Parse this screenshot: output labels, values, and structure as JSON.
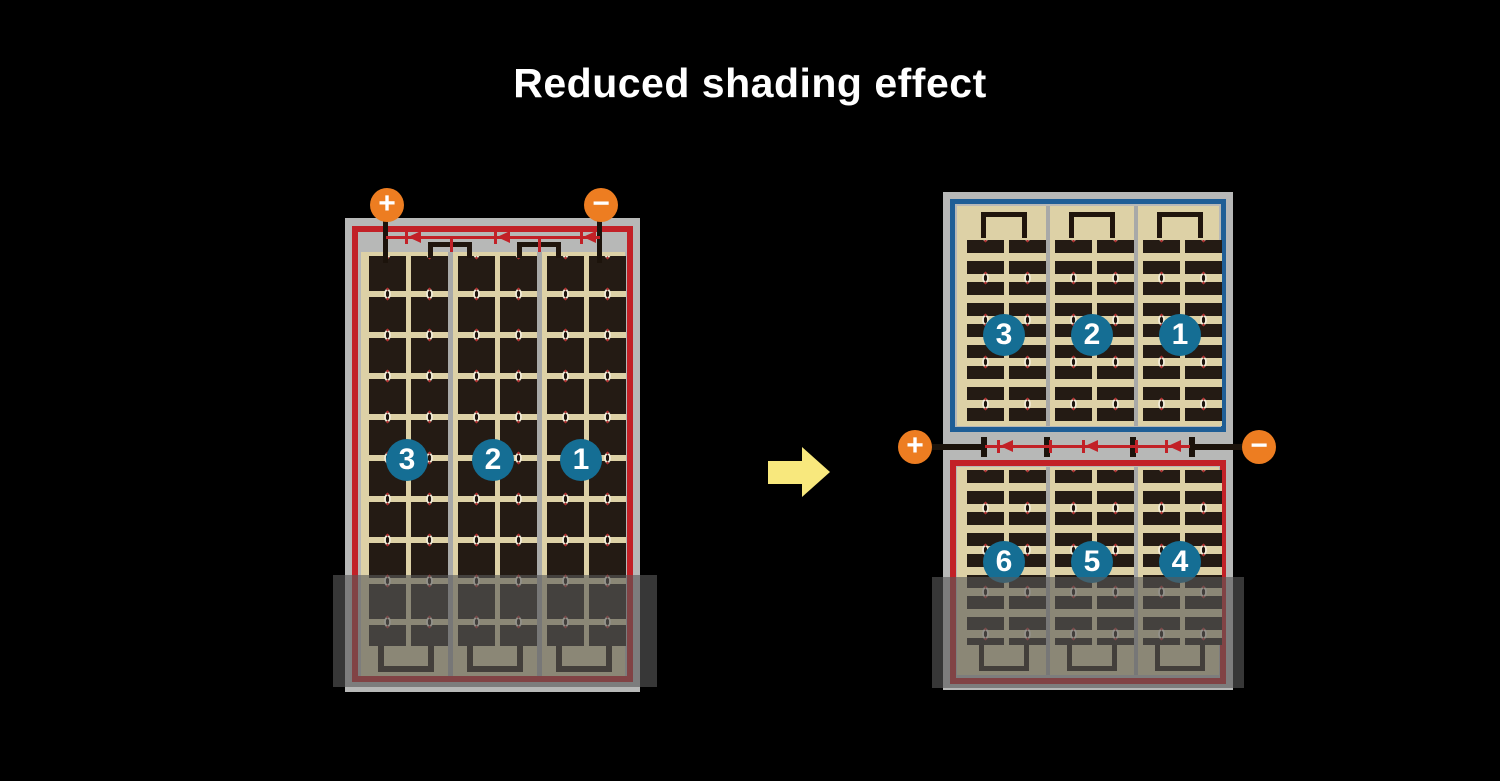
{
  "title": "Reduced shading effect",
  "left_module": {
    "terminals": {
      "plus": "+",
      "minus": "−"
    },
    "strings": [
      {
        "label": "3"
      },
      {
        "label": "2"
      },
      {
        "label": "1"
      }
    ]
  },
  "right_module": {
    "terminals": {
      "plus": "+",
      "minus": "−"
    },
    "top_half": {
      "strings": [
        {
          "label": "3"
        },
        {
          "label": "2"
        },
        {
          "label": "1"
        }
      ]
    },
    "bottom_half": {
      "strings": [
        {
          "label": "6"
        },
        {
          "label": "5"
        },
        {
          "label": "4"
        }
      ]
    }
  },
  "colors": {
    "background": "#000000",
    "title_text": "#ffffff",
    "terminal_orange": "#ed7d21",
    "circuit_red": "#c22127",
    "half_string_blue": "#1f5e96",
    "number_circle_blue": "#156e94",
    "cell_dark": "#241b14",
    "panel_tan": "#ddd1a6",
    "frame_gray": "#b7b8b7",
    "arrow_yellow": "#f8e87d",
    "shade_overlay": "rgba(88,88,88,0.62)"
  }
}
